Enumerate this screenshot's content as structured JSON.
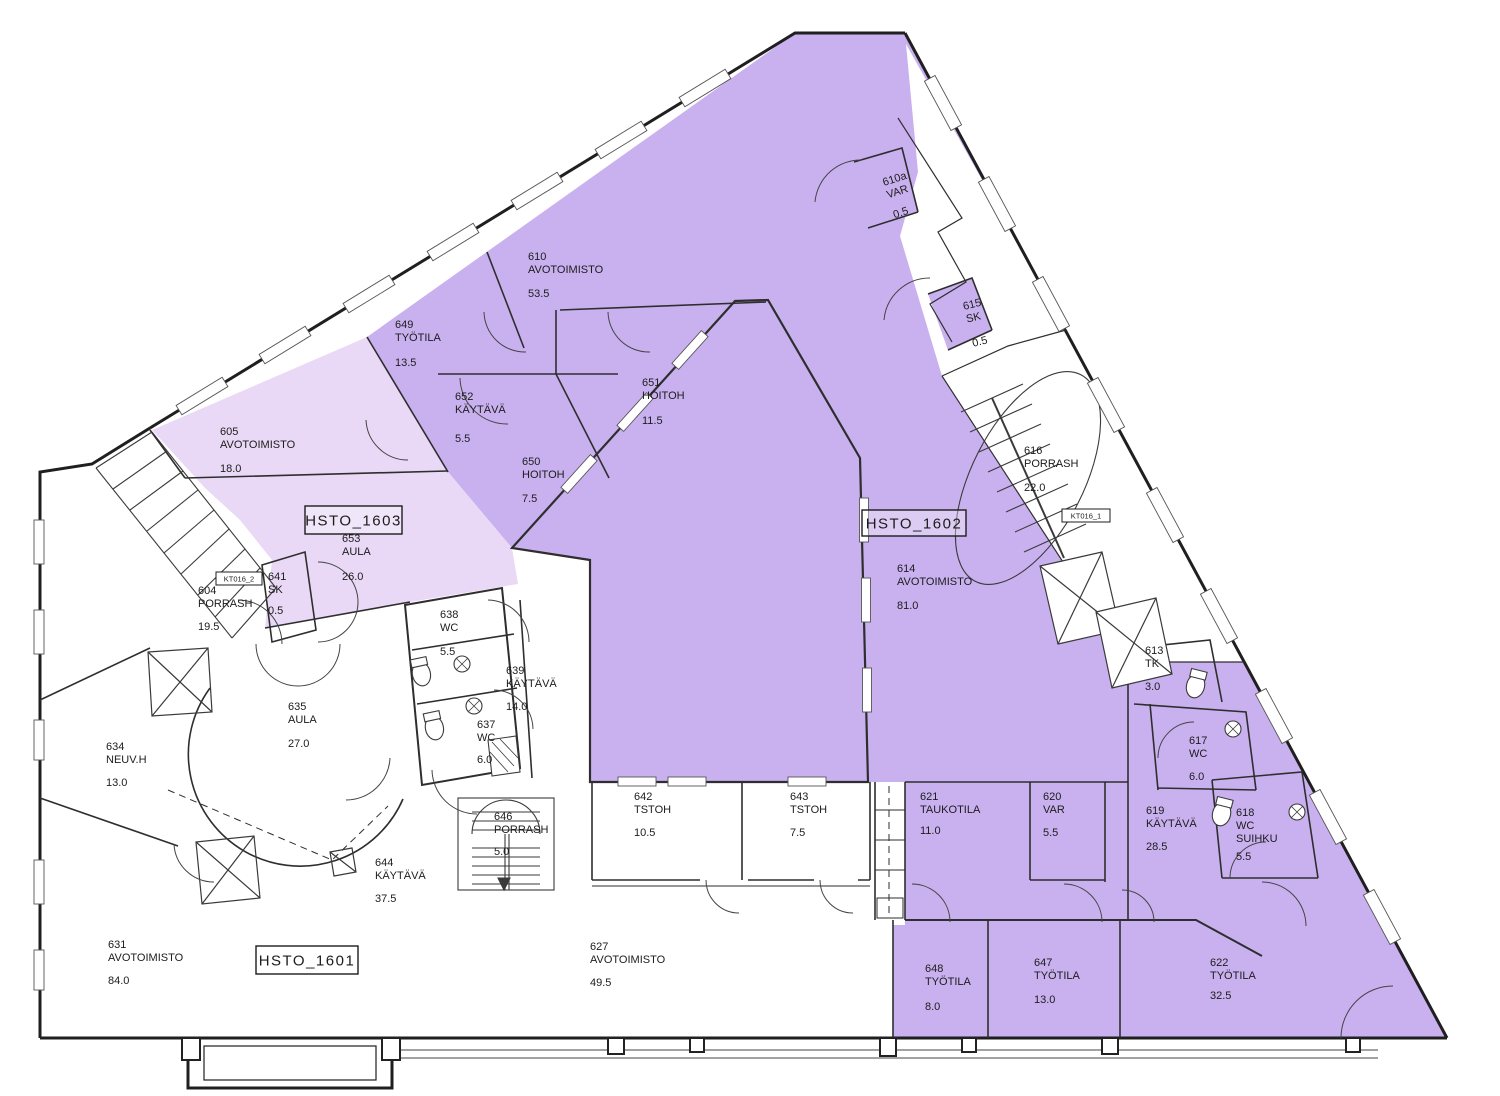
{
  "colors": {
    "zone_purple": "#c9b1ef",
    "zone_pink": "#e9d9f6",
    "wall": "#222222",
    "thin_wall": "#333333",
    "text": "#1c1c1c"
  },
  "zone_tags": [
    {
      "label": "HSTO_1603",
      "x": 305,
      "y": 506,
      "w": 97,
      "h": 28
    },
    {
      "label": "HSTO_1602",
      "x": 862,
      "y": 510,
      "w": 104,
      "h": 26
    },
    {
      "label": "HSTO_1601",
      "x": 256,
      "y": 946,
      "w": 102,
      "h": 28
    }
  ],
  "small_tags": [
    {
      "label": "KT016_2",
      "x": 216,
      "y": 572,
      "w": 46,
      "h": 13
    },
    {
      "label": "KT016_1",
      "x": 1062,
      "y": 509,
      "w": 48,
      "h": 13
    }
  ],
  "rooms": [
    {
      "id": "610a",
      "lines": [
        "610a",
        "VAR"
      ],
      "area": "0.5",
      "x": 884,
      "y": 186,
      "ay": 220,
      "rot": -18
    },
    {
      "id": "610",
      "lines": [
        "610",
        "AVOTOIMISTO"
      ],
      "area": "53.5",
      "x": 528,
      "y": 260,
      "ay": 297
    },
    {
      "id": "649",
      "lines": [
        "649",
        "TYÖTILA"
      ],
      "area": "13.5",
      "x": 395,
      "y": 328,
      "ay": 366
    },
    {
      "id": "652",
      "lines": [
        "652",
        "KÄYTÄVÄ"
      ],
      "area": "5.5",
      "x": 455,
      "y": 400,
      "ay": 442
    },
    {
      "id": "651",
      "lines": [
        "651",
        "HOITOH"
      ],
      "area": "11.5",
      "x": 642,
      "y": 386,
      "ay": 424
    },
    {
      "id": "650",
      "lines": [
        "650",
        "HOITOH"
      ],
      "area": "7.5",
      "x": 522,
      "y": 465,
      "ay": 502
    },
    {
      "id": "605",
      "lines": [
        "605",
        "AVOTOIMISTO"
      ],
      "area": "18.0",
      "x": 220,
      "y": 435,
      "ay": 472
    },
    {
      "id": "615",
      "lines": [
        "615",
        "SK"
      ],
      "area": "0.5",
      "x": 964,
      "y": 310,
      "ay": 348,
      "rot": -14
    },
    {
      "id": "616",
      "lines": [
        "616",
        "PORRASH"
      ],
      "area": "22.0",
      "x": 1024,
      "y": 454,
      "ay": 491
    },
    {
      "id": "653",
      "lines": [
        "653",
        "AULA"
      ],
      "area": "26.0",
      "x": 342,
      "y": 542,
      "ay": 580
    },
    {
      "id": "614",
      "lines": [
        "614",
        "AVOTOIMISTO"
      ],
      "area": "81.0",
      "x": 897,
      "y": 572,
      "ay": 609
    },
    {
      "id": "604",
      "lines": [
        "604",
        "PORRASH"
      ],
      "area": "19.5",
      "x": 198,
      "y": 594,
      "ay": 630
    },
    {
      "id": "641",
      "lines": [
        "641",
        "SK"
      ],
      "area": "0.5",
      "x": 268,
      "y": 580,
      "ay": 614
    },
    {
      "id": "638",
      "lines": [
        "638",
        "WC"
      ],
      "area": "5.5",
      "x": 440,
      "y": 618,
      "ay": 655
    },
    {
      "id": "639",
      "lines": [
        "639",
        "KÄYTÄVÄ"
      ],
      "area": "14.0",
      "x": 506,
      "y": 674,
      "ay": 710
    },
    {
      "id": "637",
      "lines": [
        "637",
        "WC"
      ],
      "area": "6.0",
      "x": 477,
      "y": 728,
      "ay": 763
    },
    {
      "id": "635",
      "lines": [
        "635",
        "AULA"
      ],
      "area": "27.0",
      "x": 288,
      "y": 710,
      "ay": 747
    },
    {
      "id": "634",
      "lines": [
        "634",
        "NEUV.H"
      ],
      "area": "13.0",
      "x": 106,
      "y": 750,
      "ay": 786
    },
    {
      "id": "613",
      "lines": [
        "613",
        "TK"
      ],
      "area": "3.0",
      "x": 1145,
      "y": 654,
      "ay": 690
    },
    {
      "id": "617",
      "lines": [
        "617",
        "WC"
      ],
      "area": "6.0",
      "x": 1189,
      "y": 744,
      "ay": 780
    },
    {
      "id": "619",
      "lines": [
        "619",
        "KÄYTÄVÄ"
      ],
      "area": "28.5",
      "x": 1146,
      "y": 814,
      "ay": 850
    },
    {
      "id": "618",
      "lines": [
        "618",
        "WC",
        "SUIHKU"
      ],
      "area": "5.5",
      "x": 1236,
      "y": 816,
      "ay": 860
    },
    {
      "id": "642",
      "lines": [
        "642",
        "TSTOH"
      ],
      "area": "10.5",
      "x": 634,
      "y": 800,
      "ay": 836
    },
    {
      "id": "643",
      "lines": [
        "643",
        "TSTOH"
      ],
      "area": "7.5",
      "x": 790,
      "y": 800,
      "ay": 836
    },
    {
      "id": "621",
      "lines": [
        "621",
        "TAUKOTILA"
      ],
      "area": "11.0",
      "x": 920,
      "y": 800,
      "ay": 834
    },
    {
      "id": "620",
      "lines": [
        "620",
        "VAR"
      ],
      "area": "5.5",
      "x": 1043,
      "y": 800,
      "ay": 836
    },
    {
      "id": "646",
      "lines": [
        "646",
        "PORRASH"
      ],
      "area": "5.0",
      "x": 494,
      "y": 820,
      "ay": 855
    },
    {
      "id": "644",
      "lines": [
        "644",
        "KÄYTÄVÄ"
      ],
      "area": "37.5",
      "x": 375,
      "y": 866,
      "ay": 902
    },
    {
      "id": "631",
      "lines": [
        "631",
        "AVOTOIMISTO"
      ],
      "area": "84.0",
      "x": 108,
      "y": 948,
      "ay": 984
    },
    {
      "id": "627",
      "lines": [
        "627",
        "AVOTOIMISTO"
      ],
      "area": "49.5",
      "x": 590,
      "y": 950,
      "ay": 986
    },
    {
      "id": "648",
      "lines": [
        "648",
        "TYÖTILA"
      ],
      "area": "8.0",
      "x": 925,
      "y": 972,
      "ay": 1010
    },
    {
      "id": "647",
      "lines": [
        "647",
        "TYÖTILA"
      ],
      "area": "13.0",
      "x": 1034,
      "y": 966,
      "ay": 1003
    },
    {
      "id": "622",
      "lines": [
        "622",
        "TYÖTILA"
      ],
      "area": "32.5",
      "x": 1210,
      "y": 966,
      "ay": 999
    }
  ]
}
